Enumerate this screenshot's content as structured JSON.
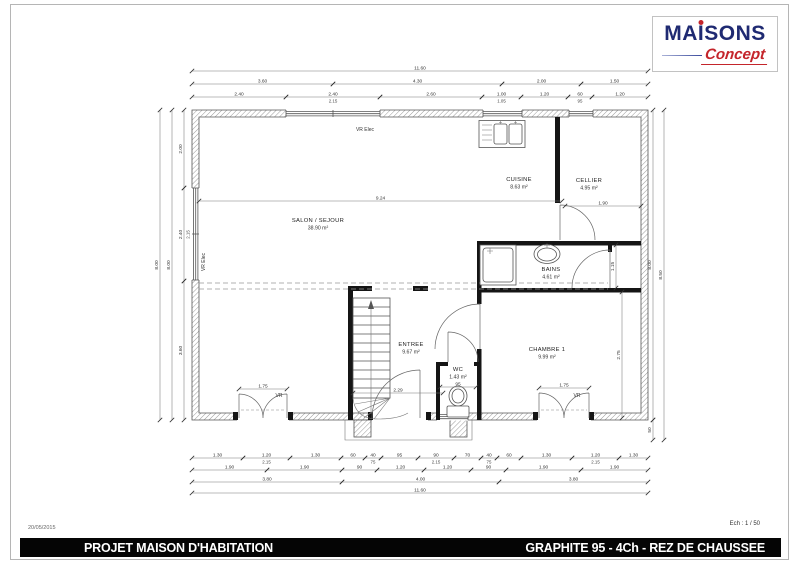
{
  "logo": {
    "brand_pre": "MA",
    "brand_i": "I",
    "brand_post": "SONS",
    "tagline": "Concept",
    "brand_color": "#1f2a72",
    "accent_color": "#c4252b"
  },
  "footer": {
    "date": "20/05/2015",
    "scale": "Ech : 1 / 50",
    "left_title": "PROJET MAISON D'HABITATION",
    "right_title": "GRAPHITE 95 - 4Ch - REZ DE CHAUSSEE"
  },
  "plan": {
    "rooms": [
      {
        "name": "SALON / SEJOUR",
        "area": "38.90 m²",
        "x": 318,
        "y": 222
      },
      {
        "name": "CUISINE",
        "area": "8.63 m²",
        "x": 519,
        "y": 181
      },
      {
        "name": "CELLIER",
        "area": "4.95 m²",
        "x": 589,
        "y": 182
      },
      {
        "name": "BAINS",
        "area": "4.61 m²",
        "x": 551,
        "y": 271
      },
      {
        "name": "ENTREE",
        "area": "9.67 m²",
        "x": 411,
        "y": 346
      },
      {
        "name": "WC",
        "area": "1.43 m²",
        "x": 458,
        "y": 371
      },
      {
        "name": "CHAMBRE 1",
        "area": "9.99 m²",
        "x": 547,
        "y": 351
      }
    ],
    "annotations": [
      {
        "t": "VR Elec",
        "x": 365,
        "y": 131,
        "rot": 0
      },
      {
        "t": "VR Elec",
        "x": 205,
        "y": 262,
        "rot": -90
      },
      {
        "t": "VR",
        "x": 279,
        "y": 397,
        "rot": 0
      },
      {
        "t": "VR",
        "x": 577,
        "y": 397,
        "rot": 0
      }
    ],
    "hdims": [
      {
        "x1": 192,
        "x2": 648,
        "y": 71,
        "label": "11.60"
      },
      {
        "x1": 192,
        "x2": 333,
        "y": 84,
        "label": "3.60"
      },
      {
        "x1": 333,
        "x2": 502,
        "y": 84,
        "label": "4.30"
      },
      {
        "x1": 502,
        "x2": 581,
        "y": 84,
        "label": "2.00"
      },
      {
        "x1": 581,
        "x2": 648,
        "y": 84,
        "label": "1.50"
      },
      {
        "x1": 192,
        "x2": 286,
        "y": 97,
        "label": "2.40"
      },
      {
        "x1": 286,
        "x2": 380,
        "y": 97,
        "label": "2.40",
        "sub": "2.15"
      },
      {
        "x1": 380,
        "x2": 482,
        "y": 97,
        "label": "2.60"
      },
      {
        "x1": 482,
        "x2": 521,
        "y": 97,
        "label": "1.00",
        "sub": "1.05"
      },
      {
        "x1": 521,
        "x2": 568,
        "y": 97,
        "label": "1.20"
      },
      {
        "x1": 568,
        "x2": 592,
        "y": 97,
        "label": "60",
        "sub": "95"
      },
      {
        "x1": 592,
        "x2": 648,
        "y": 97,
        "label": "1.20"
      },
      {
        "x1": 199,
        "x2": 562,
        "y": 201,
        "label": "9.24"
      },
      {
        "x1": 565,
        "x2": 641,
        "y": 206,
        "label": "1.90"
      },
      {
        "x1": 353,
        "x2": 443,
        "y": 393,
        "label": "2.29"
      },
      {
        "x1": 440,
        "x2": 476,
        "y": 387,
        "label": "95"
      },
      {
        "x1": 239,
        "x2": 287,
        "y": 389,
        "label": "1.75"
      },
      {
        "x1": 539,
        "x2": 589,
        "y": 388,
        "label": "1.75"
      },
      {
        "x1": 192,
        "x2": 243,
        "y": 458,
        "label": "1.30"
      },
      {
        "x1": 243,
        "x2": 290,
        "y": 458,
        "label": "1.20",
        "sub": "2.15"
      },
      {
        "x1": 290,
        "x2": 341,
        "y": 458,
        "label": "1.30"
      },
      {
        "x1": 341,
        "x2": 365,
        "y": 458,
        "label": "60"
      },
      {
        "x1": 365,
        "x2": 381,
        "y": 458,
        "label": "40",
        "sub": "75"
      },
      {
        "x1": 381,
        "x2": 418,
        "y": 458,
        "label": "95"
      },
      {
        "x1": 418,
        "x2": 454,
        "y": 458,
        "label": "90",
        "sub": "2.15"
      },
      {
        "x1": 454,
        "x2": 481,
        "y": 458,
        "label": "70"
      },
      {
        "x1": 481,
        "x2": 497,
        "y": 458,
        "label": "40",
        "sub": "75"
      },
      {
        "x1": 497,
        "x2": 521,
        "y": 458,
        "label": "60"
      },
      {
        "x1": 521,
        "x2": 572,
        "y": 458,
        "label": "1.30"
      },
      {
        "x1": 572,
        "x2": 619,
        "y": 458,
        "label": "1.20",
        "sub": "2.15"
      },
      {
        "x1": 619,
        "x2": 648,
        "y": 458,
        "label": "1.30"
      },
      {
        "x1": 192,
        "x2": 267,
        "y": 470,
        "label": "1.90"
      },
      {
        "x1": 267,
        "x2": 342,
        "y": 470,
        "label": "1.90"
      },
      {
        "x1": 342,
        "x2": 377,
        "y": 470,
        "label": "90"
      },
      {
        "x1": 377,
        "x2": 424,
        "y": 470,
        "label": "1.20"
      },
      {
        "x1": 424,
        "x2": 471,
        "y": 470,
        "label": "1.20"
      },
      {
        "x1": 471,
        "x2": 506,
        "y": 470,
        "label": "90"
      },
      {
        "x1": 506,
        "x2": 581,
        "y": 470,
        "label": "1.90"
      },
      {
        "x1": 581,
        "x2": 648,
        "y": 470,
        "label": "1.90"
      },
      {
        "x1": 192,
        "x2": 342,
        "y": 482,
        "label": "3.80"
      },
      {
        "x1": 342,
        "x2": 499,
        "y": 482,
        "label": "4.00"
      },
      {
        "x1": 499,
        "x2": 648,
        "y": 482,
        "label": "3.80"
      },
      {
        "x1": 192,
        "x2": 648,
        "y": 493,
        "label": "11.60"
      }
    ],
    "vdims": [
      {
        "x": 160,
        "y1": 110,
        "y2": 420,
        "label": "8.00"
      },
      {
        "x": 172,
        "y1": 110,
        "y2": 420,
        "label": "8.00"
      },
      {
        "x": 184,
        "y1": 110,
        "y2": 188,
        "label": "2.00"
      },
      {
        "x": 184,
        "y1": 188,
        "y2": 281,
        "label": "2.40",
        "sub": "2.15"
      },
      {
        "x": 184,
        "y1": 281,
        "y2": 420,
        "label": "3.60"
      },
      {
        "x": 653,
        "y1": 110,
        "y2": 420,
        "label": "8.00"
      },
      {
        "x": 653,
        "y1": 420,
        "y2": 440,
        "label": "50"
      },
      {
        "x": 664,
        "y1": 110,
        "y2": 440,
        "label": "8.50"
      },
      {
        "x": 616,
        "y1": 245,
        "y2": 288,
        "label": "1.15"
      },
      {
        "x": 622,
        "y1": 292,
        "y2": 418,
        "label": "2.75"
      }
    ]
  }
}
